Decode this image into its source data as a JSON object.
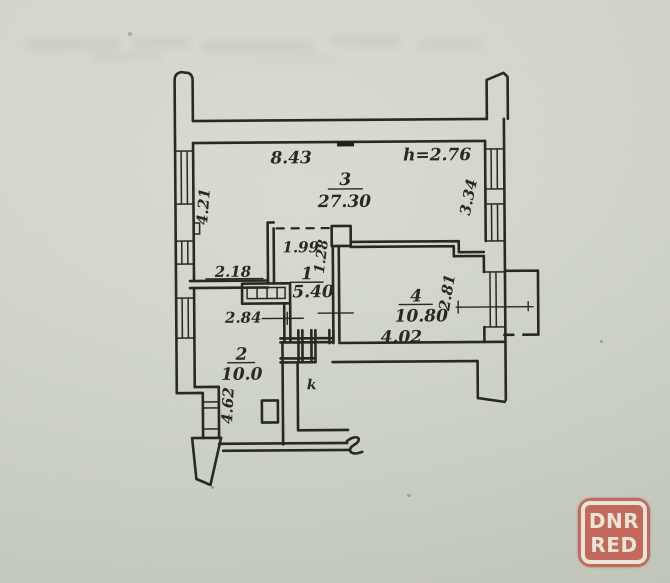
{
  "plan": {
    "height_note": "h=2.76",
    "rooms": {
      "r3": {
        "number": "3",
        "area": "27.30"
      },
      "r1": {
        "number": "1",
        "area": "5.40"
      },
      "r2": {
        "number": "2",
        "area": "10.0"
      },
      "r4": {
        "number": "4",
        "area": "10.80"
      }
    },
    "dimensions": {
      "top_width": "8.43",
      "left_upper": "4.21",
      "right_upper": "3.34",
      "room2_top": "2.18",
      "room1_width": "1.99",
      "room1_depth": "1.28",
      "hall_width": "2.84",
      "room4_bottom": "4.02",
      "balcony_side": "2.81",
      "left_lower": "4.62",
      "door_mark": "k"
    }
  },
  "watermark": {
    "line1": "DNR",
    "line2": "RED"
  }
}
